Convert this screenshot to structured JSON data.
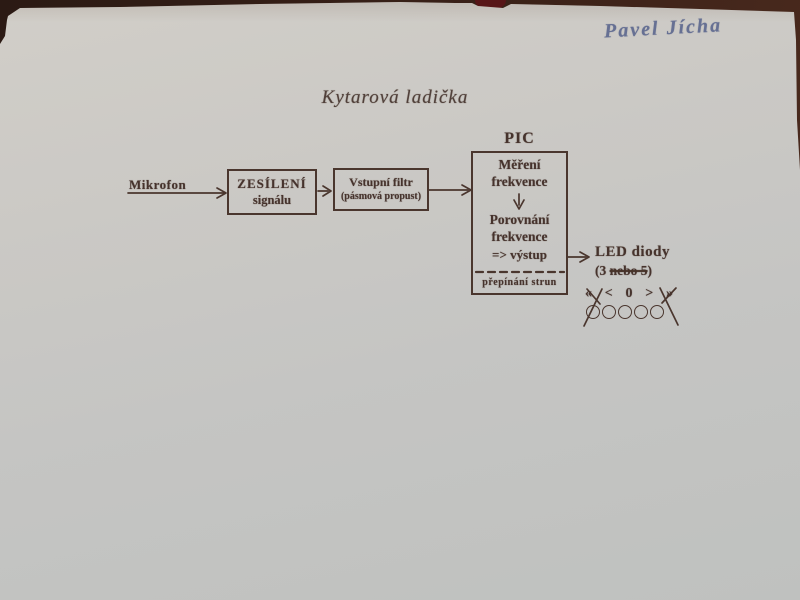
{
  "colors": {
    "background_table": "#3a2118",
    "paper": "#c9c8c4",
    "printed_ink": "#46332d",
    "handwriting_ink": "#667093",
    "red_object": "#571517"
  },
  "handwritten_name": "Pavel Jícha",
  "title": "Kytarová ladička",
  "diagram": {
    "microphone_label": "Mikrofon",
    "amplifier_box": {
      "line1": "ZESÍLENÍ",
      "line2": "signálu"
    },
    "filter_box": {
      "line1": "Vstupní filtr",
      "line2": "(pásmová propust)"
    },
    "pic_label": "PIC",
    "pic_box": {
      "measure_line1": "Měření",
      "measure_line2": "frekvence",
      "compare_line1": "Porovnání",
      "compare_line2": "frekvence",
      "output_line": "=> výstup",
      "footer": "přepínání strun"
    },
    "led_label_line1": "LED diody",
    "led_label_line2_prefix": "(3 ",
    "led_label_line2_struck": "nebo 5",
    "led_label_line2_suffix": ")"
  },
  "led_indicator": {
    "symbols": [
      "«",
      "<",
      "0",
      ">",
      "»"
    ],
    "crossed_out_symbols": [
      "«",
      "»"
    ],
    "circle_count": 5,
    "crossed_out_circles": "first and last"
  }
}
